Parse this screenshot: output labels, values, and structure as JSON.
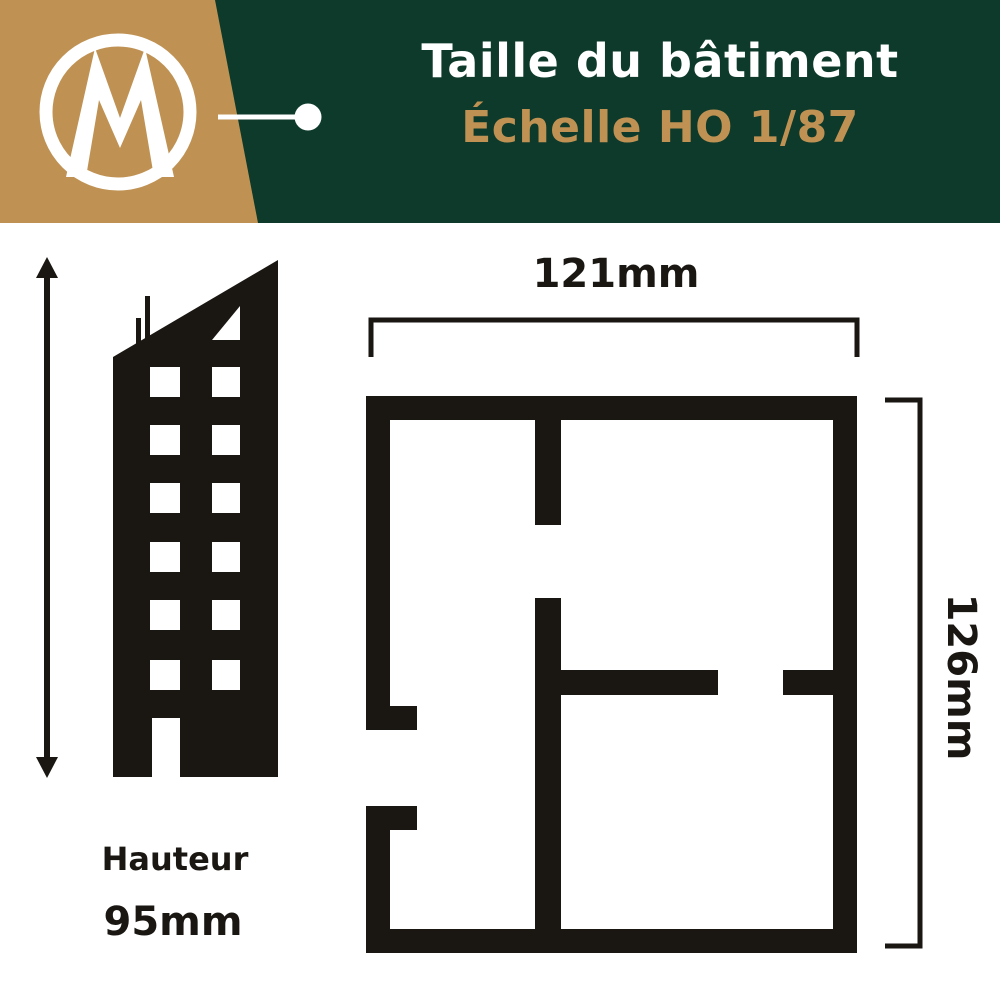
{
  "header": {
    "logo_letter": "M",
    "title": "Taille du bâtiment",
    "subtitle": "Échelle HO 1/87"
  },
  "building": {
    "height_label": "Hauteur",
    "height_value": "95mm"
  },
  "floor_plan": {
    "width_value": "121mm",
    "depth_value": "126mm"
  },
  "colors": {
    "header_green": "#0d3a2b",
    "brand_gold": "#bf9254",
    "ink_black": "#1a1612",
    "background_white": "#ffffff"
  },
  "icons": {
    "logo": "m-monogram-in-circle",
    "connector": "callout-line-with-dot",
    "height_arrow": "vertical-double-arrow",
    "building": "building-silhouette",
    "floor_plan": "floor-plan-outline"
  }
}
